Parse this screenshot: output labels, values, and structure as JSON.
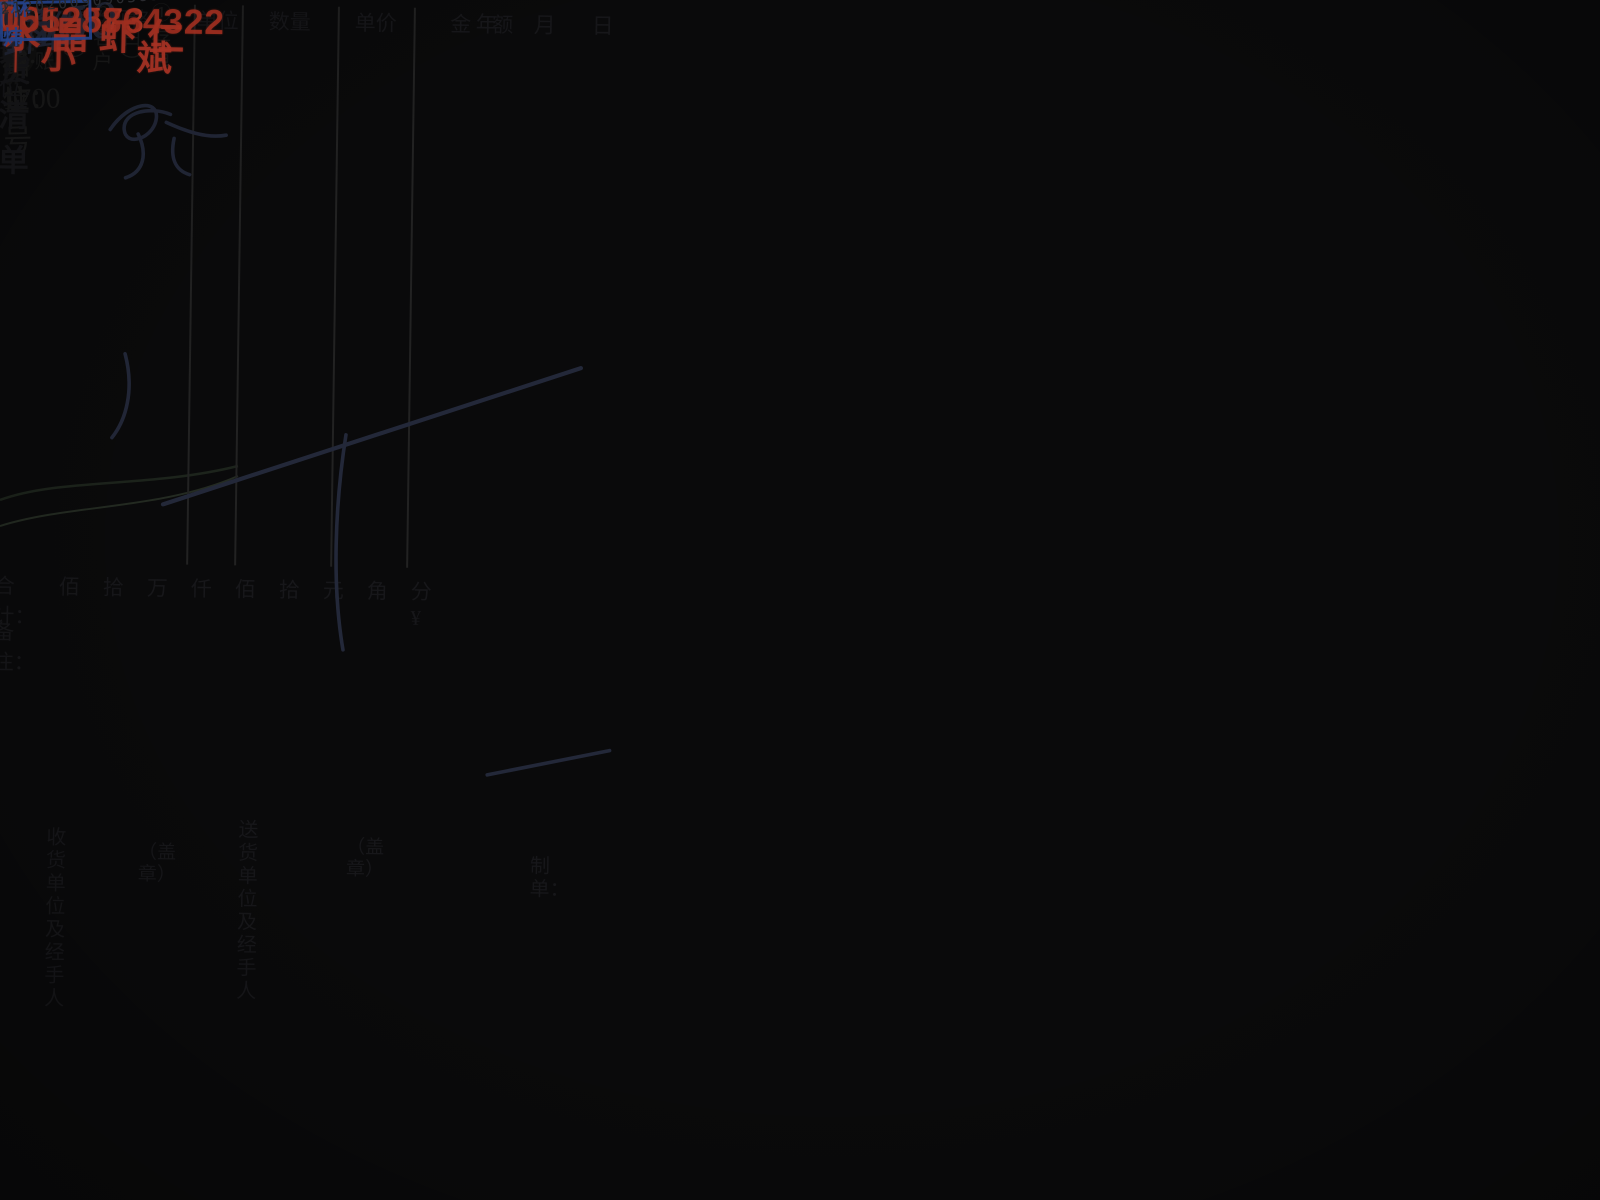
{
  "colors": {
    "stamp_red": "#c23b2a",
    "stamp_blue": "#2e54b0",
    "serial_red": "#c8432d",
    "ink": "#232839",
    "pink_paper": "#dcc3d1",
    "green_surface": "#d5e4c2"
  },
  "environment": {
    "device_brand": "Panas",
    "wall_label": "机",
    "tally_rows": [
      "",
      "6",
      "7",
      "8",
      "9",
      "10",
      "11",
      "",
      ""
    ]
  },
  "pink_sheet": {
    "clipped_header": "上海县记清单（按进国货）",
    "copy_labels": "第一联存根（白）　第二联客户（红）　第三客户（蓝）　第四联结算联（黄）"
  },
  "receipt": {
    "title": "销货清单",
    "serial": "0012573",
    "recipient_label": "收货单位：",
    "address_label": "地　址：",
    "year_label": "年",
    "month_label": "月",
    "day_label": "日",
    "handwritten": {
      "month": "9",
      "day": "9",
      "item": "虾仁",
      "qty_price": "3×50",
      "amount": "¥150",
      "total": "150"
    },
    "red_stamp": {
      "line1": "水晶虾仁",
      "marks": "丨丨",
      "line2": "小　斌",
      "phone": "15528864322"
    },
    "table_headers": [
      "名称及规格",
      "单位",
      "数量",
      "单价",
      "金　额"
    ],
    "total_row": {
      "label": "合计：",
      "units": [
        "佰",
        "拾",
        "万",
        "仟",
        "佰",
        "拾",
        "元",
        "角",
        "分¥"
      ]
    },
    "remark_label": "备注：",
    "footer": {
      "receiver_line1": "收货单位",
      "receiver_line2": "及经手人",
      "seal": "（盖章）",
      "sender_line1": "送货单位",
      "sender_line2": "及经手人",
      "seal2": "（盖章）",
      "maker_label": "制单："
    },
    "copy_note": "①存根（白）　②客户（红）　③记账（黄）",
    "name_stamp": "林　炜",
    "barcode": {
      "number": "212020090903832",
      "mark": "1"
    }
  },
  "bottom_sheet": {
    "issuer_label": "开票单位：",
    "phone_label": "电话：",
    "shop_address_label": "商铺地址：",
    "shop_address_value": "泰和路1700号"
  }
}
